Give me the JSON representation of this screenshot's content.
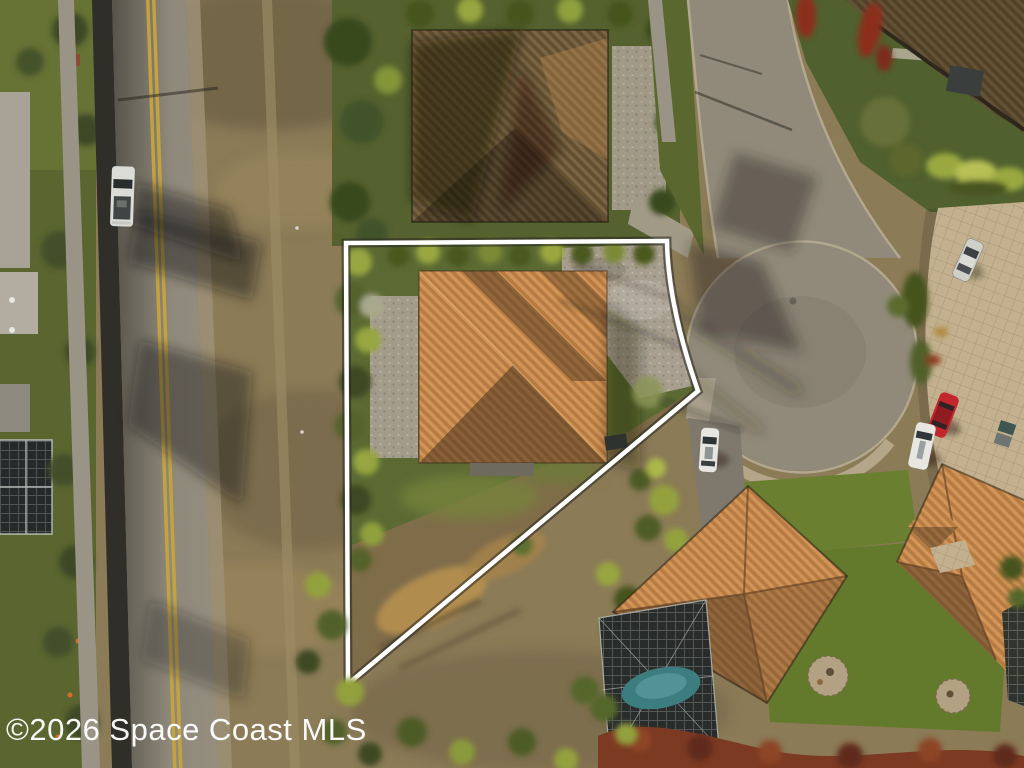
{
  "watermark": {
    "text": "©2026 Space Coast MLS",
    "color": "#ffffff"
  },
  "palette": {
    "boundary_white": "#ffffff",
    "road_asphalt_dark": "#57534a",
    "road_asphalt_light": "#8f897b",
    "lane_yellow": "#c7a43c",
    "sidewalk": "#9a9487",
    "wall_shadow": "#2f2e29",
    "dry_field": "#8b7b57",
    "scrub_brown": "#7f6c49",
    "scrub_gold": "#b8924f",
    "street_pavement": "#918a7a",
    "curb": "#b2a88f",
    "apron": "#b7ab8f",
    "pavers": "#c2b08e",
    "gravel": "#a89f90",
    "lawn": "#5b6a33",
    "lawn_bright": "#6a8030",
    "lawn_north": "#55612e",
    "hedge_bright": "#97a63f",
    "hedge_dark": "#45531f",
    "tree_dark": "#3c4a23",
    "roof_tile_light": "#d29457",
    "roof_tile_dark": "#b67c43",
    "roof_shade_light": "#7b6544",
    "roof_shade_dark": "#635030",
    "mulch_red": "#7c3a22",
    "red_flower": "#8c2f1f",
    "pool_teal": "#3c7d80",
    "screen_dark": "#242a2a",
    "car_red": "#c1272d",
    "car_white": "#e8e6e0",
    "car_silver": "#cfcfc9",
    "truck_white": "#dcdcd6",
    "pad_paver": "#b3a183"
  }
}
